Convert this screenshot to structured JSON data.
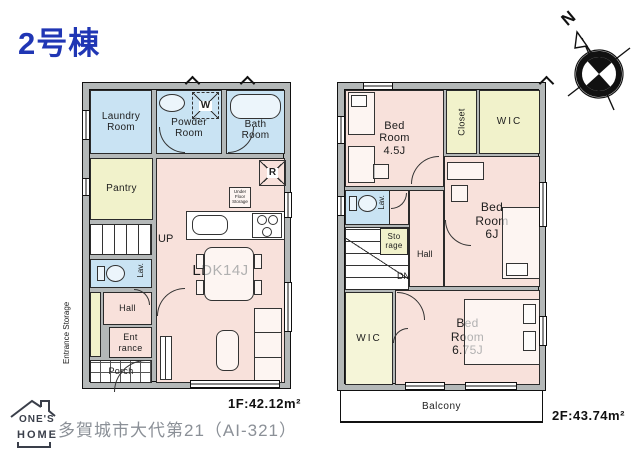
{
  "title": "2号棟",
  "compass": {
    "north": "N"
  },
  "floor1": {
    "area": "1F:42.12m²",
    "labels": {
      "laundry": "Laundry\nRoom",
      "powder": "Powder\nRoom",
      "bath": "Bath\nRoom",
      "pantry": "Pantry",
      "ldk": "LDK14J",
      "up": "UP",
      "lav": "Lav.",
      "hall": "Hall",
      "entrance": "Ent\nrance",
      "porch": "Porch",
      "entrance_storage": "Entrance Storage",
      "washer": "W",
      "refrigerator": "R",
      "under_floor": "Under\nFloor\nStorage"
    }
  },
  "floor2": {
    "area": "2F:43.74m²",
    "labels": {
      "bed45": "Bed\nRoom\n4.5J",
      "closet": "Closet",
      "wic_top": "WIC",
      "bed6": "Bed\nRoom\n6J",
      "lav": "Lav.",
      "storage": "Sto\nrage",
      "hall": "Hall",
      "dn": "DN",
      "wic_bottom": "WIC",
      "bed675": "Bed\nRoom\n6.75J",
      "balcony": "Balcony"
    }
  },
  "footer": {
    "logo_top": "ONE'S",
    "logo_bottom": "HOME",
    "address": "多賀城市大代第21（AI-321）"
  },
  "colors": {
    "wet_room": "#c9e3f3",
    "living_room": "#f8e1db",
    "storage_room": "#f1f2cb",
    "wall": "#b4b8b8",
    "title_blue": "#2036b4",
    "address_gray": "#8b9097"
  }
}
